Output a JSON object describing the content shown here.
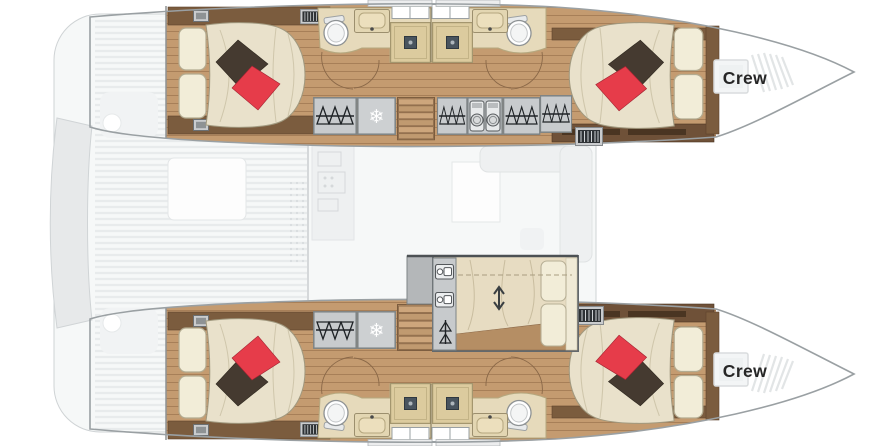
{
  "plan": {
    "labels": {
      "crew_port": "Crew",
      "crew_starboard": "Crew"
    },
    "glyphs": {
      "snowflake": "❄"
    },
    "colors": {
      "hull_outline": "#9aa0a3",
      "label_text": "#262626",
      "wood_floor": "#c49b70",
      "wood_dark": "#6f5138",
      "counter_beige": "#e6dabb",
      "shower_tan": "#dccb9e",
      "cabinet_gray": "#c8cbcd",
      "bed_linen": "#e9e1cb",
      "pillow_cream": "#f2edd8",
      "accent_red": "#e63c4a",
      "accent_dark_pillow": "#453a30",
      "faded_deck": "#f6f8f8"
    },
    "icons": [
      "hanger-icon",
      "snowflake-icon",
      "washer-icon",
      "toilet-icon",
      "sink-icon",
      "shower-drain-icon",
      "stairs-icon",
      "berth-icon",
      "updown-arrow-icon",
      "vent-grille-icon",
      "ceiling-hatch-icon",
      "door-swing-icon"
    ]
  }
}
